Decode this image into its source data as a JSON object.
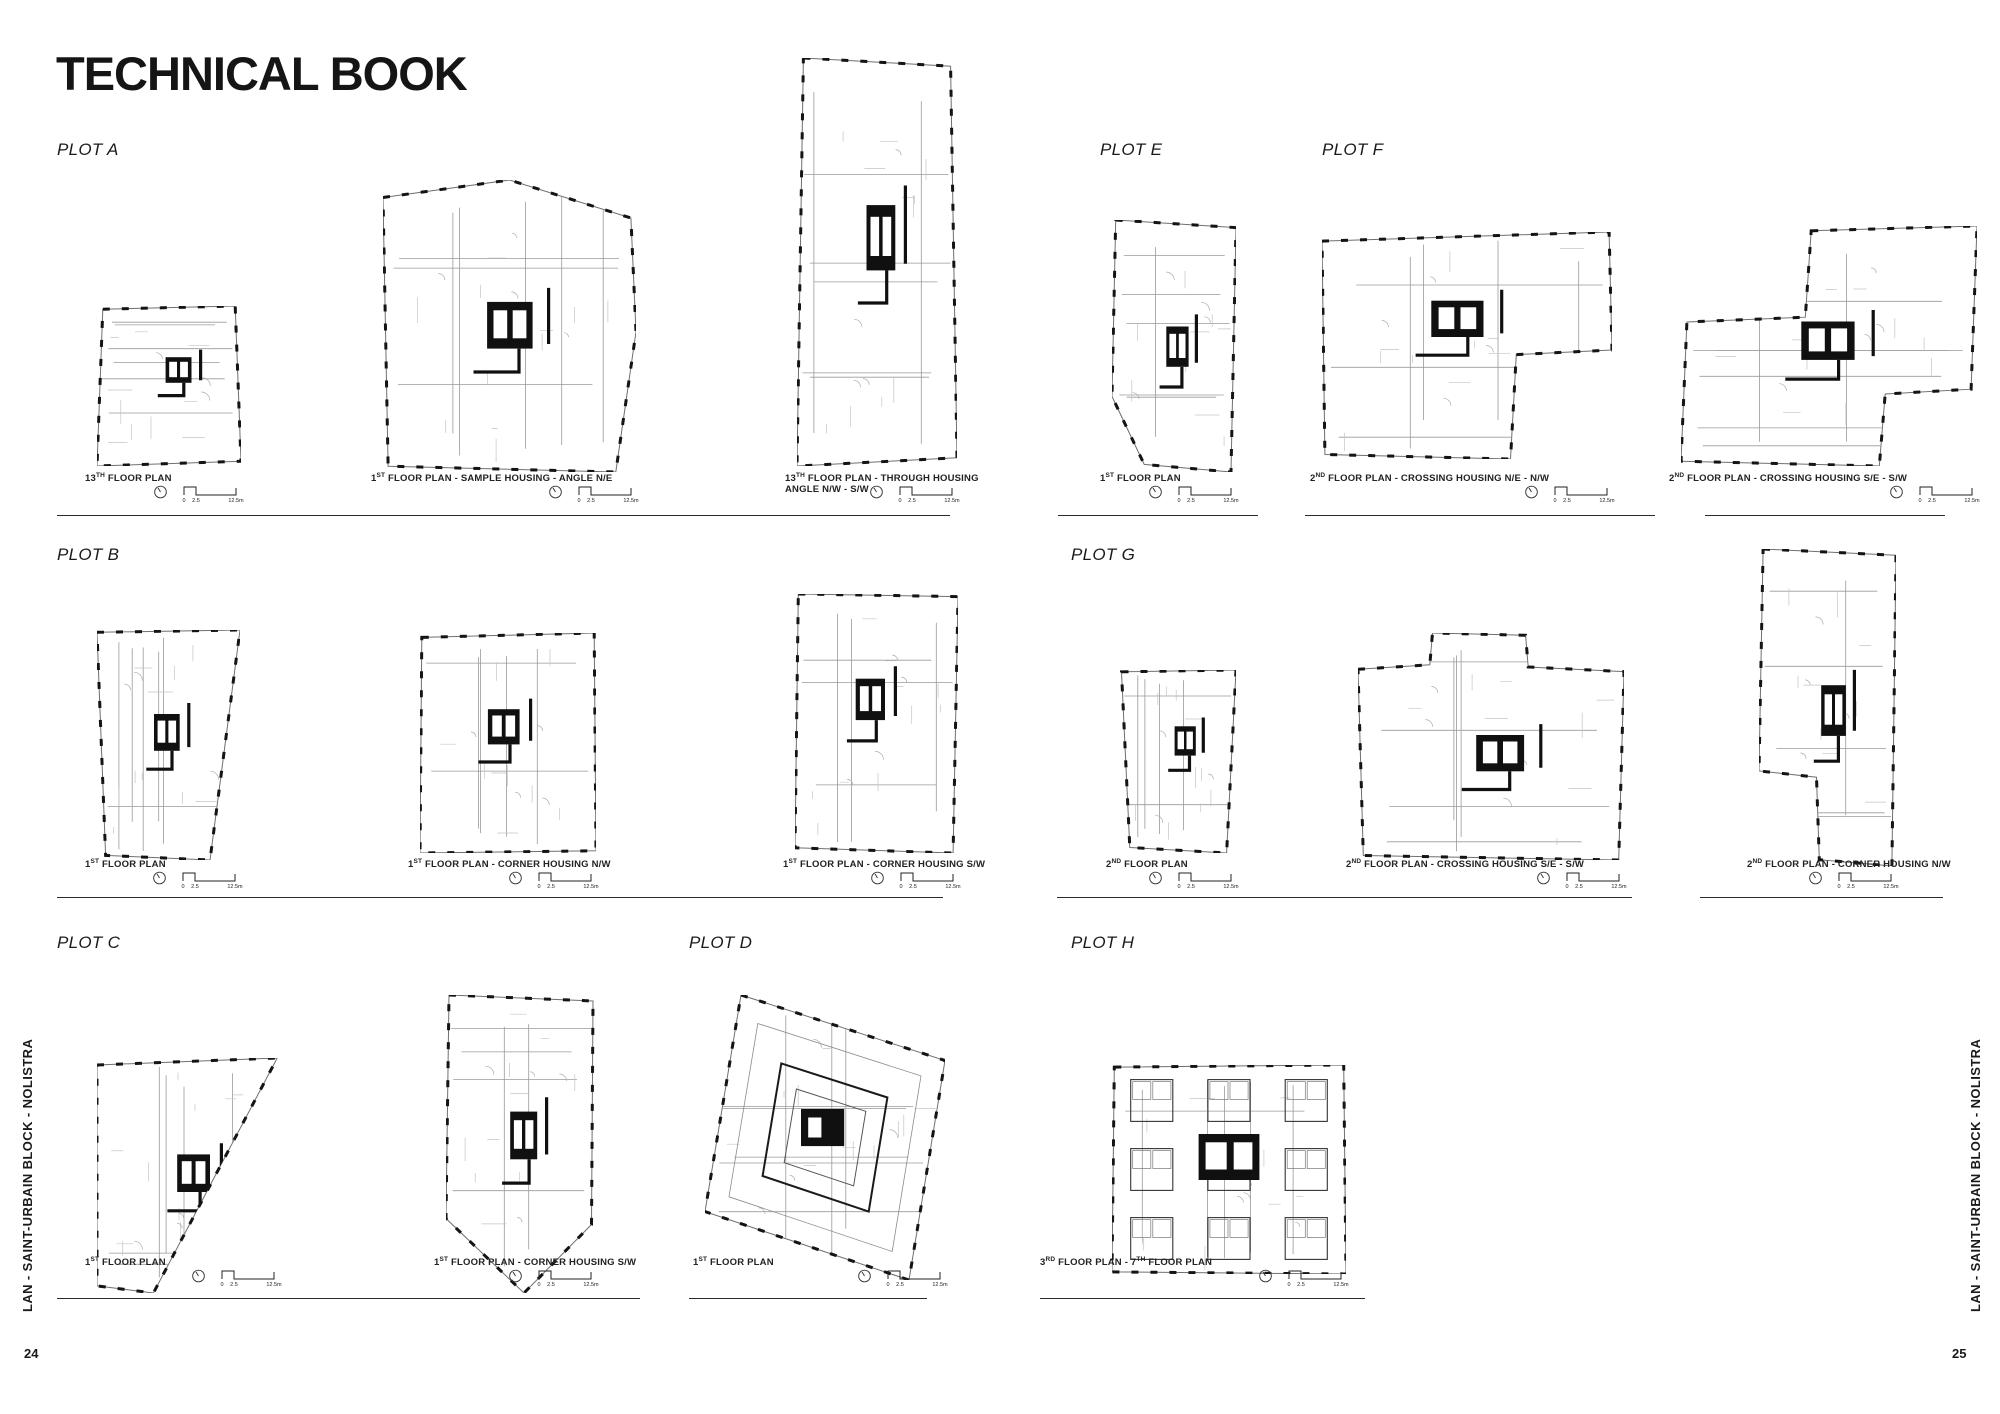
{
  "page": {
    "title": "TECHNICAL BOOK",
    "side_text": "LAN - SAINT-URBAIN BLOCK - NOLISTRA",
    "left_page_number": "24",
    "right_page_number": "25"
  },
  "scale_bar": {
    "ticks": [
      "0",
      "2.5",
      "12.5m"
    ],
    "north_icon": "north-arrow-icon"
  },
  "plots": [
    {
      "id": "A",
      "label": "PLOT A"
    },
    {
      "id": "B",
      "label": "PLOT B"
    },
    {
      "id": "C",
      "label": "PLOT C"
    },
    {
      "id": "D",
      "label": "PLOT D"
    },
    {
      "id": "E",
      "label": "PLOT E"
    },
    {
      "id": "F",
      "label": "PLOT F"
    },
    {
      "id": "G",
      "label": "PLOT G"
    },
    {
      "id": "H",
      "label": "PLOT H"
    }
  ],
  "figures": [
    {
      "id": "a1",
      "plot": "A",
      "caption": "13TH FLOOR PLAN"
    },
    {
      "id": "a2",
      "plot": "A",
      "caption": "1ST FLOOR PLAN - SAMPLE HOUSING - ANGLE N/E"
    },
    {
      "id": "a3",
      "plot": "A",
      "caption": "13TH FLOOR PLAN - THROUGH HOUSING\nANGLE N/W - S/W"
    },
    {
      "id": "e1",
      "plot": "E",
      "caption": "1ST FLOOR PLAN"
    },
    {
      "id": "f1",
      "plot": "F",
      "caption": "2ND FLOOR PLAN - CROSSING HOUSING N/E - N/W"
    },
    {
      "id": "f2",
      "plot": "F",
      "caption": "2ND FLOOR PLAN - CROSSING HOUSING S/E - S/W"
    },
    {
      "id": "b1",
      "plot": "B",
      "caption": "1ST FLOOR PLAN"
    },
    {
      "id": "b2",
      "plot": "B",
      "caption": "1ST FLOOR PLAN - CORNER HOUSING N/W"
    },
    {
      "id": "b3",
      "plot": "B",
      "caption": "1ST FLOOR PLAN - CORNER HOUSING S/W"
    },
    {
      "id": "g1",
      "plot": "G",
      "caption": "2ND FLOOR PLAN"
    },
    {
      "id": "g2",
      "plot": "G",
      "caption": "2ND FLOOR PLAN - CROSSING HOUSING S/E - S/W"
    },
    {
      "id": "g3",
      "plot": "G",
      "caption": "2ND FLOOR PLAN - CORNER HOUSING N/W"
    },
    {
      "id": "c1",
      "plot": "C",
      "caption": "1ST FLOOR PLAN"
    },
    {
      "id": "c2",
      "plot": "C",
      "caption": "1ST FLOOR PLAN - CORNER HOUSING S/W"
    },
    {
      "id": "d1",
      "plot": "D",
      "caption": "1ST FLOOR PLAN"
    },
    {
      "id": "h1",
      "plot": "H",
      "caption": "3RD FLOOR PLAN - 7TH FLOOR PLAN"
    }
  ],
  "colors": {
    "ink": "#141414",
    "light_line": "#9a9a9a",
    "paper": "#ffffff"
  }
}
